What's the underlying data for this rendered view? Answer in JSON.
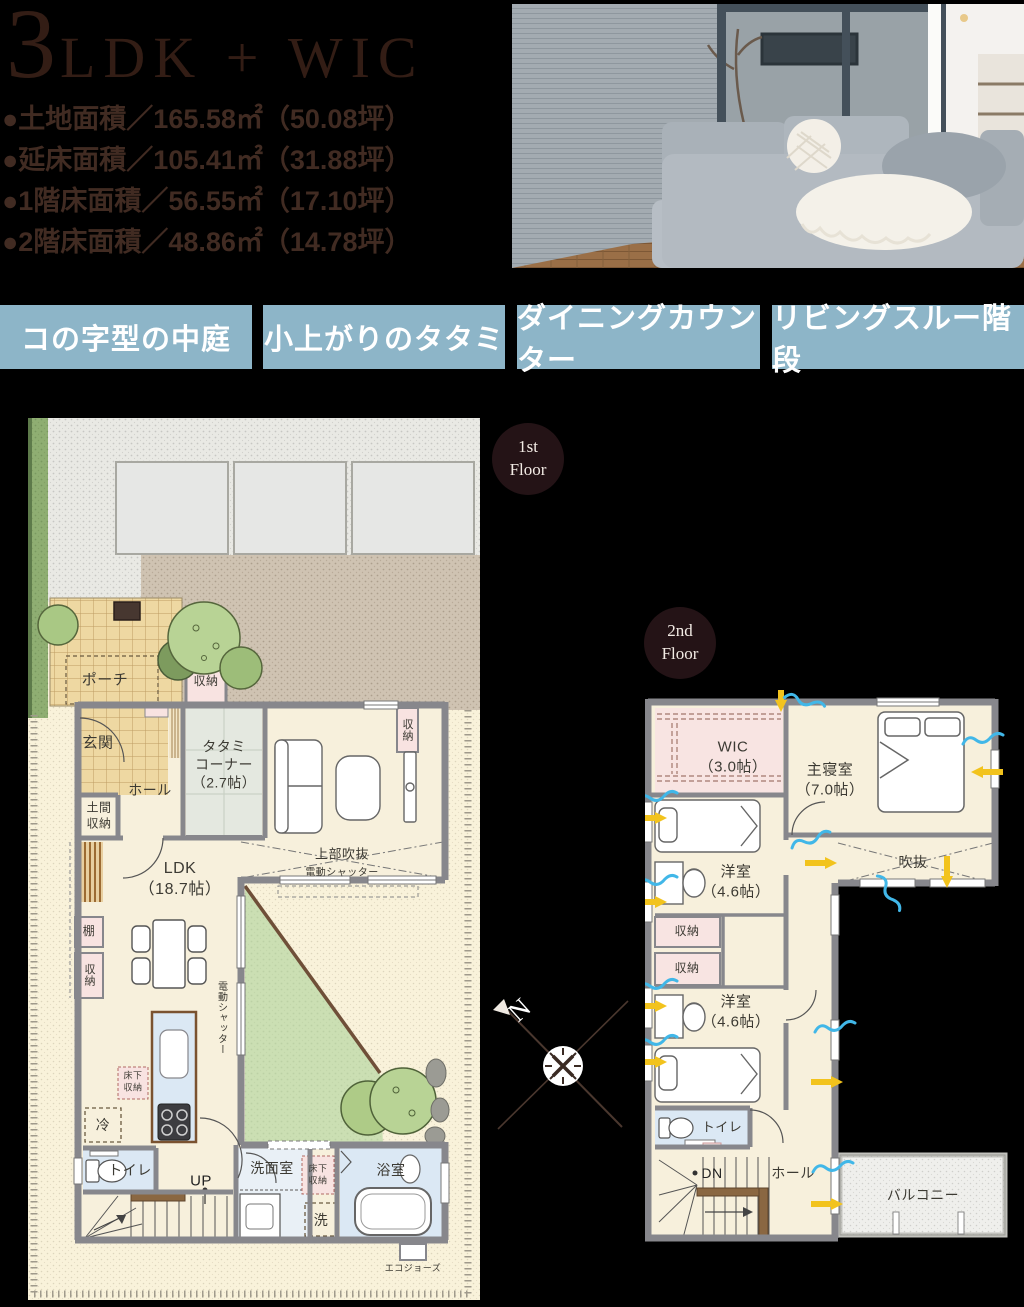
{
  "header": {
    "title_big": "3",
    "title_small": "LDK + WIC",
    "specs": [
      "●土地面積／165.58㎡（50.08坪）",
      "●延床面積／105.41㎡（31.88坪）",
      "●1階床面積／56.55㎡（17.10坪）",
      "●2階床面積／48.86㎡（14.78坪）"
    ]
  },
  "tags": [
    "コの字型の中庭",
    "小上がりのタタミ",
    "ダイニングカウンター",
    "リビングスルー階段"
  ],
  "colors": {
    "tag_bg": "#8db5c8",
    "badge_bg": "#241316",
    "title_text": "#331d15",
    "courtyard_green": "#cbdfb3",
    "wet_room_blue": "#dbe8f4",
    "storage_pink": "#f8e3e1",
    "wall_gray": "#87878c",
    "airflow_blue": "#41b7e8",
    "airflow_yellow": "#f2c31d"
  },
  "floor1": {
    "badge": "1st\nFloor",
    "rooms": {
      "porch": "ポーチ",
      "storage": "収納",
      "entrance": "玄関",
      "hall": "ホール",
      "doma_storage": "土間\n収納",
      "tatami_corner": "タタミ\nコーナー\n（2.7帖）",
      "ldk": "LDK\n（18.7帖）",
      "upper_void": "上部吹抜",
      "electric_shutter": "電動シャッター",
      "shelf": "棚",
      "underfloor_storage": "床下\n収納",
      "fridge": "冷",
      "toilet": "トイレ",
      "up": "UP",
      "washroom": "洗面室",
      "washer": "洗",
      "bathroom": "浴室",
      "water_heater": "エコジョーズ"
    }
  },
  "floor2": {
    "badge": "2nd\nFloor",
    "rooms": {
      "wic": "WIC\n（3.0帖）",
      "master_bedroom": "主寝室\n（7.0帖）",
      "void": "吹抜",
      "bedroom": "洋室\n（4.6帖）",
      "storage": "収納",
      "toilet": "トイレ",
      "down": "DN",
      "hall": "ホール",
      "balcony": "バルコニー"
    }
  },
  "compass": {
    "north": "N"
  }
}
